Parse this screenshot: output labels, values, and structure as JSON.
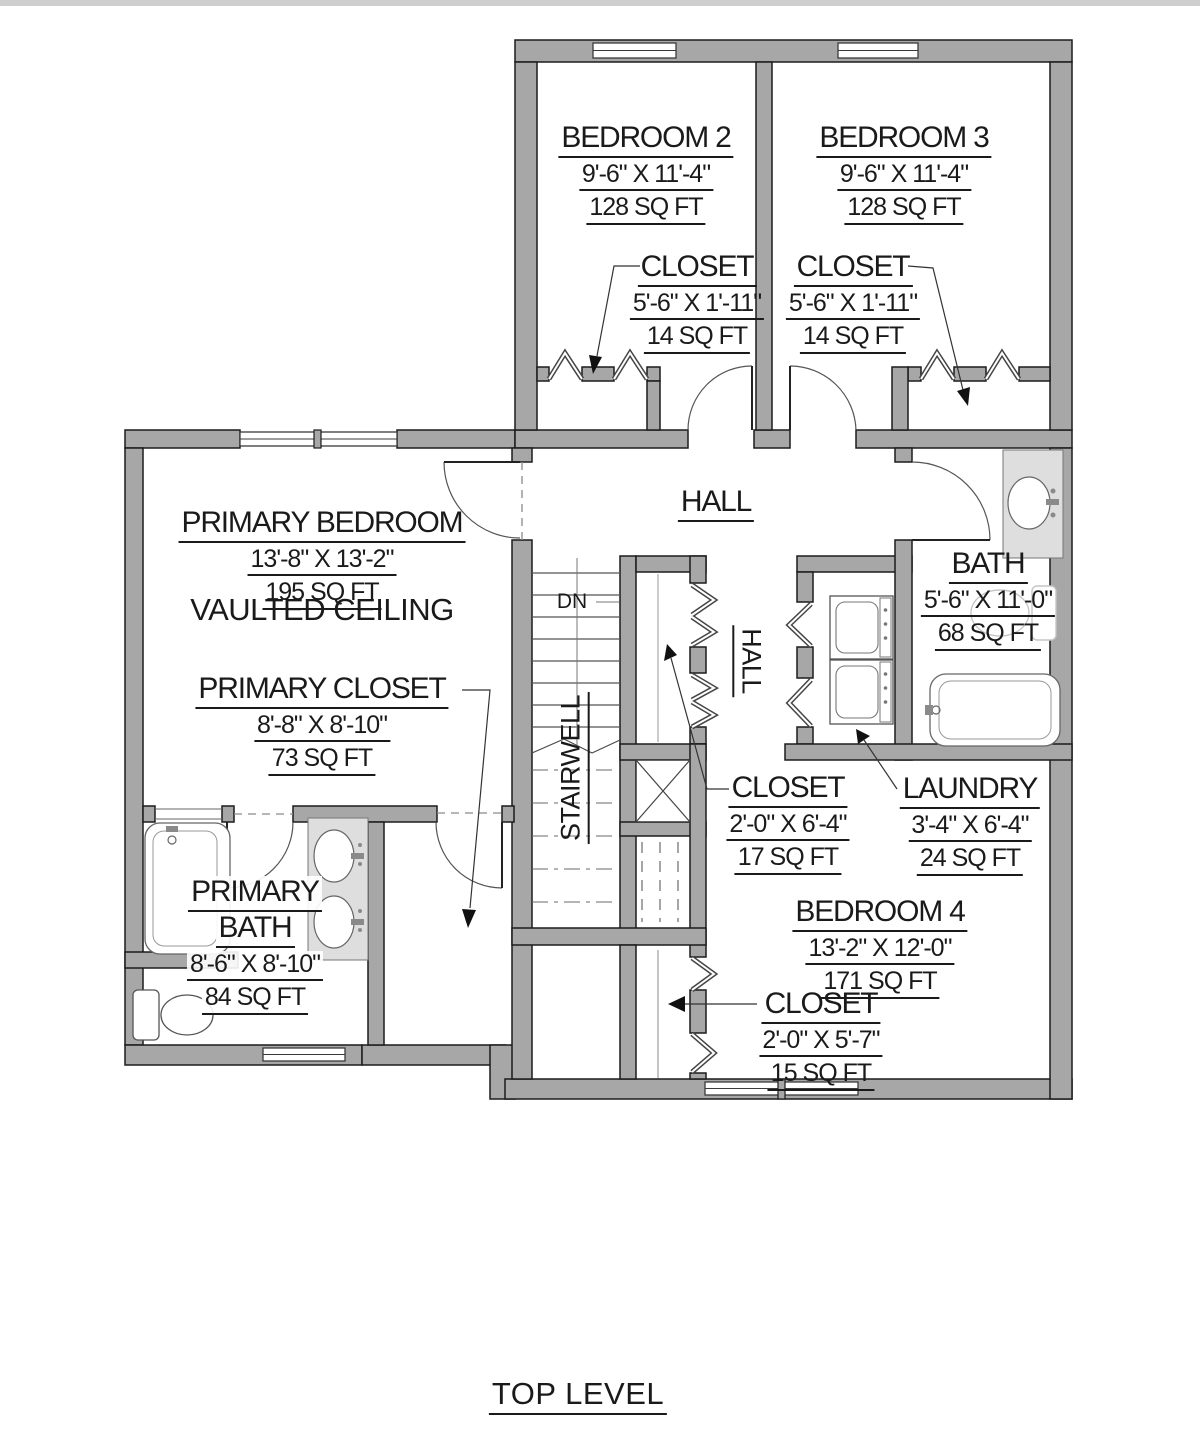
{
  "title": "TOP LEVEL",
  "colors": {
    "wall_fill": "#a7a7a7",
    "wall_edge": "#1c1c1c",
    "counter_fill": "#dedede",
    "text": "#1a1a1a"
  },
  "rooms": {
    "bedroom2": {
      "name": "BEDROOM 2",
      "dims": "9'-6\" X 11'-4\"",
      "area": "128 SQ FT"
    },
    "bedroom3": {
      "name": "BEDROOM 3",
      "dims": "9'-6\" X 11'-4\"",
      "area": "128 SQ FT"
    },
    "bedroom2_closet": {
      "name": "CLOSET",
      "dims": "5'-6\" X 1'-11\"",
      "area": "14 SQ FT"
    },
    "bedroom3_closet": {
      "name": "CLOSET",
      "dims": "5'-6\" X 1'-11\"",
      "area": "14 SQ FT"
    },
    "hall": {
      "name": "HALL"
    },
    "hall_lower": {
      "name": "HALL"
    },
    "primary_bedroom": {
      "name": "PRIMARY BEDROOM",
      "dims": "13'-8\" X 13'-2\"",
      "area": "195 SQ FT",
      "note": "VAULTED CEILING"
    },
    "primary_closet": {
      "name": "PRIMARY CLOSET",
      "dims": "8'-8\" X 8'-10\"",
      "area": "73 SQ FT"
    },
    "primary_bath": {
      "name_line1": "PRIMARY",
      "name_line2": "BATH",
      "dims": "8'-6\" X 8'-10\"",
      "area": "84 SQ FT"
    },
    "bath": {
      "name": "BATH",
      "dims": "5'-6\" X 11'-0\"",
      "area": "68 SQ FT"
    },
    "stairwell": {
      "name": "STAIRWELL",
      "direction": "DN"
    },
    "hall_closet": {
      "name": "CLOSET",
      "dims": "2'-0\" X 6'-4\"",
      "area": "17 SQ FT"
    },
    "laundry": {
      "name": "LAUNDRY",
      "dims": "3'-4\" X 6'-4\"",
      "area": "24 SQ FT"
    },
    "bedroom4": {
      "name": "BEDROOM 4",
      "dims": "13'-2\" X 12'-0\"",
      "area": "171 SQ FT"
    },
    "bedroom4_closet": {
      "name": "CLOSET",
      "dims": "2'-0\" X 5'-7\"",
      "area": "15 SQ FT"
    }
  }
}
